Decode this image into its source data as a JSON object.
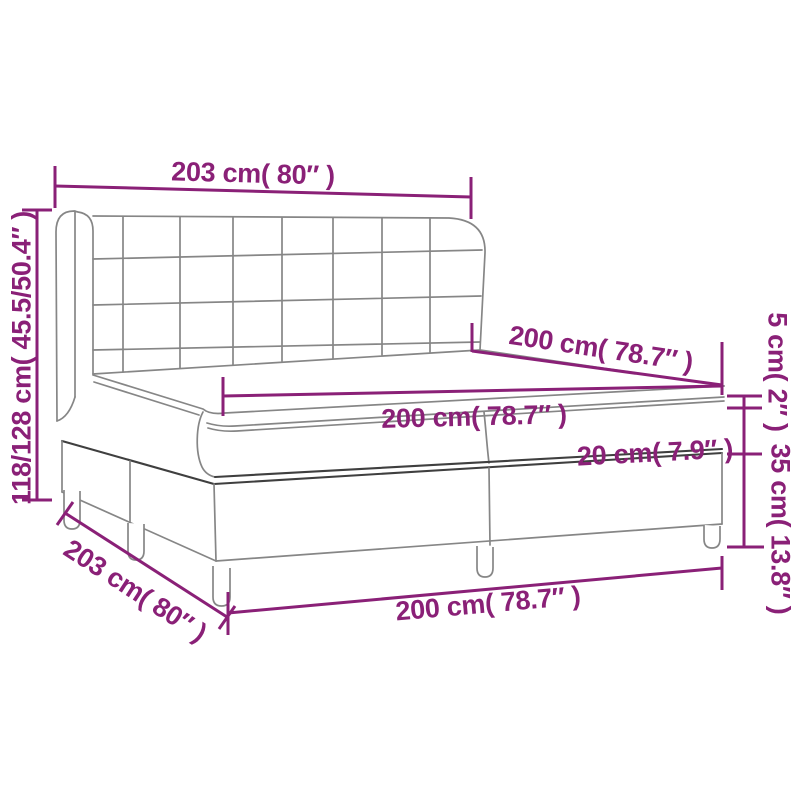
{
  "diagram": {
    "type": "product-dimension-diagram",
    "subject": "box spring bed with winged headboard, two-piece base, mattress and topper",
    "colors": {
      "dimension": "#8a2077",
      "outline": "#868686",
      "outline_dark": "#3f3f3f",
      "background": "#ffffff"
    },
    "labels": {
      "headboard_width": "203 cm( 80″ )",
      "bed_height": "118/128 cm( 45.5/50.4″ )",
      "mattress_length": "200 cm( 78.7″ )",
      "mattress_width": "200 cm( 78.7″ )",
      "mattress_thickness": "20 cm( 7.9″ )",
      "topper_thickness": "5 cm( 2″ )",
      "base_height": "35 cm( 13.8″ )",
      "base_depth": "203 cm( 80″ )",
      "base_width": "200 cm( 78.7″ )"
    }
  }
}
